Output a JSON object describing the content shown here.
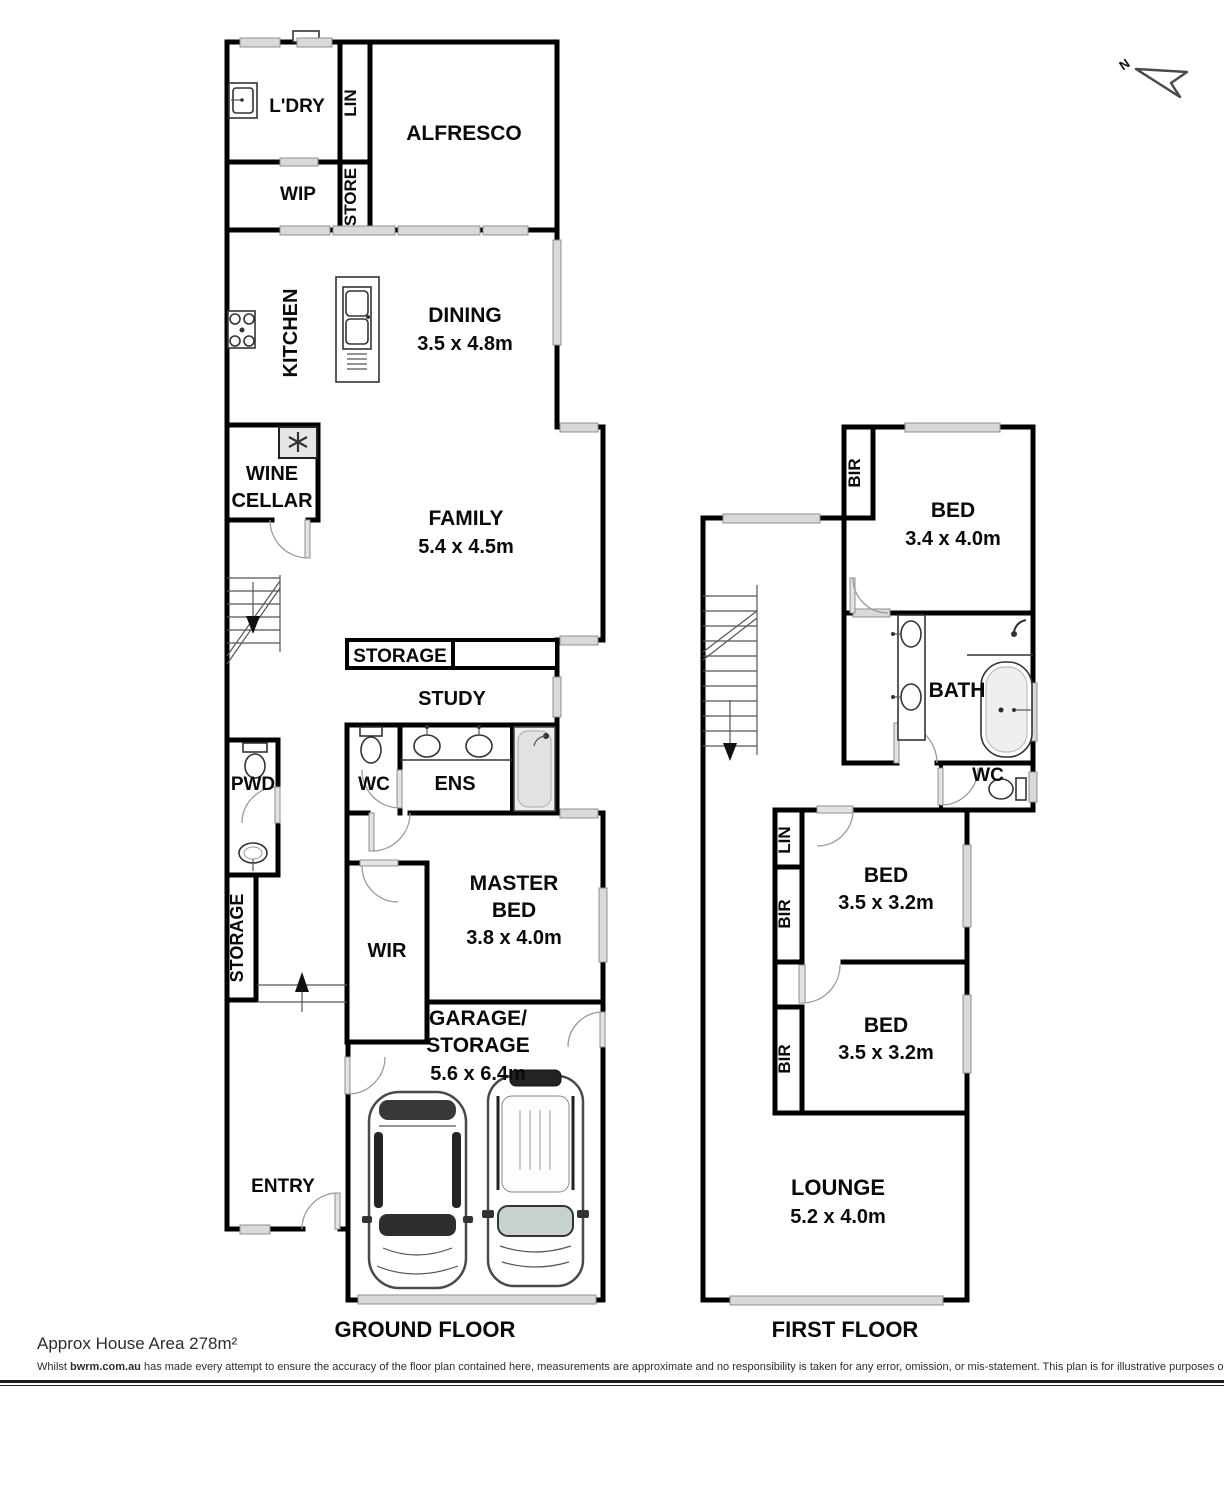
{
  "north_arrow": {
    "label": "N"
  },
  "ground_floor": {
    "title": "GROUND FLOOR",
    "labels": {
      "ldry": "L'DRY",
      "lin": "LIN",
      "alfresco": "ALFRESCO",
      "wip": "WIP",
      "store": "STORE",
      "kitchen": "KITCHEN",
      "dining": "DINING",
      "dining_dims": "3.5 x 4.8m",
      "wine_line1": "WINE",
      "wine_line2": "CELLAR",
      "family": "FAMILY",
      "family_dims": "5.4 x 4.5m",
      "storage_box": "STORAGE",
      "study": "STUDY",
      "wc": "WC",
      "ens": "ENS",
      "pwd": "PWD",
      "storage_side": "STORAGE",
      "wir": "WIR",
      "master_line1": "MASTER",
      "master_line2": "BED",
      "master_dims": "3.8 x 4.0m",
      "garage_line1": "GARAGE/",
      "garage_line2": "STORAGE",
      "garage_dims": "5.6 x 6.4m",
      "entry": "ENTRY"
    }
  },
  "first_floor": {
    "title": "FIRST FLOOR",
    "labels": {
      "bir1": "BIR",
      "bed1": "BED",
      "bed1_dims": "3.4 x 4.0m",
      "bath": "BATH",
      "wc": "WC",
      "lin": "LIN",
      "bir2": "BIR",
      "bed2": "BED",
      "bed2_dims": "3.5 x 3.2m",
      "bir3": "BIR",
      "bed3": "BED",
      "bed3_dims": "3.5 x 3.2m",
      "lounge": "LOUNGE",
      "lounge_dims": "5.2 x 4.0m"
    }
  },
  "footer": {
    "area_note": "Approx House Area 278m²",
    "disclaimer_prefix": "Whilst ",
    "disclaimer_brand": "bwrm.com.au",
    "disclaimer_rest": " has made every attempt to ensure the accuracy of the floor plan contained here, measurements are approximate and no responsibility is taken for any error, omission, or mis-statement. This plan is for illustrative purposes only."
  },
  "colors": {
    "wall": "#000000",
    "window_fill": "#d9d9d9",
    "door_leaf": "#e3e3e3",
    "text": "#0a0a0a",
    "footer_text": "#2d2d2d"
  }
}
